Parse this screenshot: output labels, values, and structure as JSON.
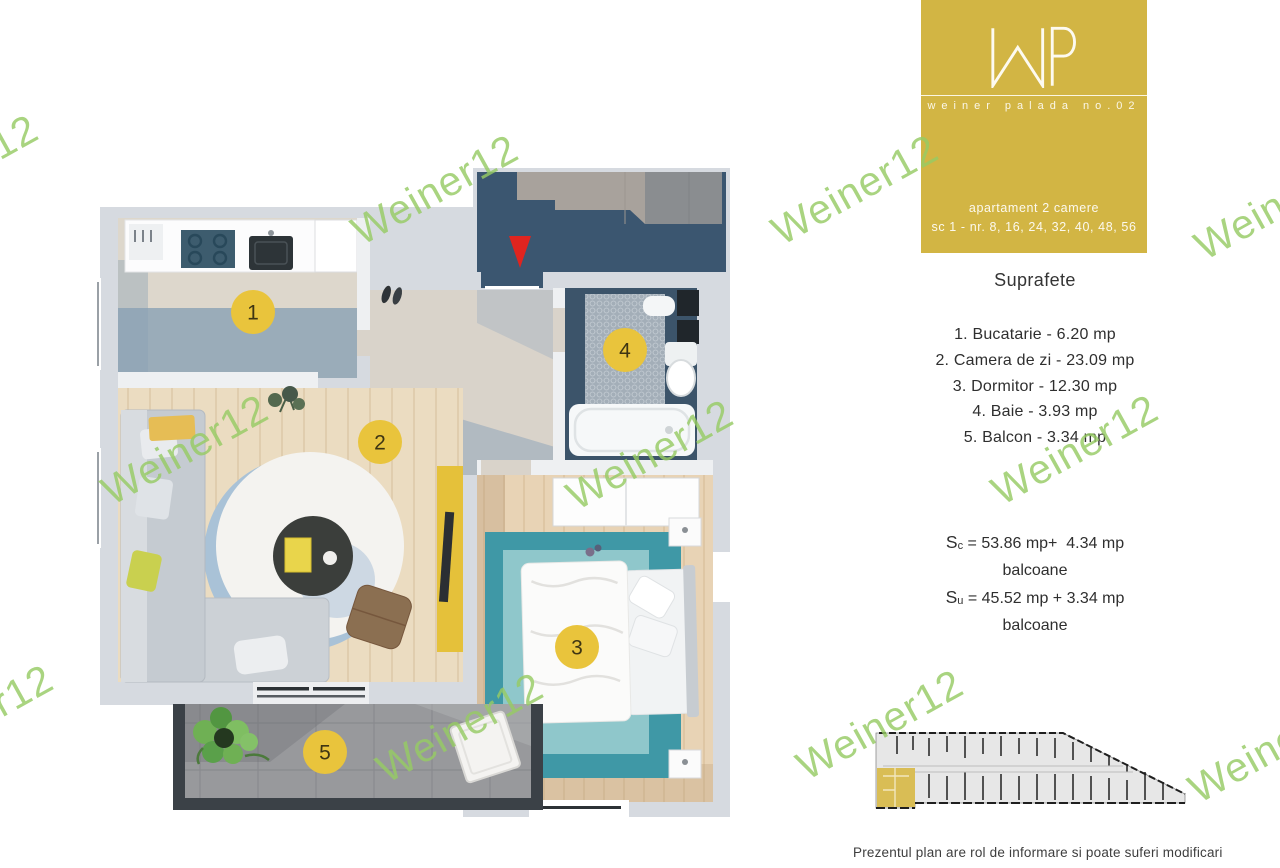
{
  "watermark": {
    "text": "Weiner12"
  },
  "logo_card": {
    "monogram": "WP",
    "brand_line": "weiner palada no.02",
    "apartment_type": "apartament 2 camere",
    "unit_numbers": "sc 1 - nr. 8, 16, 24, 32, 40, 48, 56",
    "bg_color": "#d2b544"
  },
  "surfaces": {
    "heading": "Suprafete",
    "rooms": [
      {
        "marker": "1",
        "name": "Bucatarie",
        "area": "6.20 mp",
        "line": "1. Bucatarie - 6.20 mp"
      },
      {
        "marker": "2",
        "name": "Camera de zi",
        "area": "23.09 mp",
        "line": "2. Camera de zi - 23.09 mp"
      },
      {
        "marker": "3",
        "name": "Dormitor",
        "area": "12.30 mp",
        "line": "3. Dormitor - 12.30 mp"
      },
      {
        "marker": "4",
        "name": "Baie",
        "area": "3.93 mp",
        "line": "4. Baie - 3.93 mp"
      },
      {
        "marker": "5",
        "name": "Balcon",
        "area": "3.34 mp",
        "line": "5. Balcon - 3.34 mp"
      }
    ],
    "totals": [
      {
        "symbol": "S",
        "subscript": "c",
        "rest": " = 53.86 mp+  4.34 mp",
        "line2": "balcoane"
      },
      {
        "symbol": "S",
        "subscript": "u",
        "rest": " = 45.52 mp + 3.34 mp",
        "line2": "balcoane"
      }
    ]
  },
  "floor_plan": {
    "marker_color": "#e9c43c",
    "entrance_arrow_color": "#e0241f"
  },
  "key_plan": {
    "highlight_color": "#d9bd55"
  },
  "disclaimer": "Prezentul plan are rol de informare si poate suferi modificari"
}
